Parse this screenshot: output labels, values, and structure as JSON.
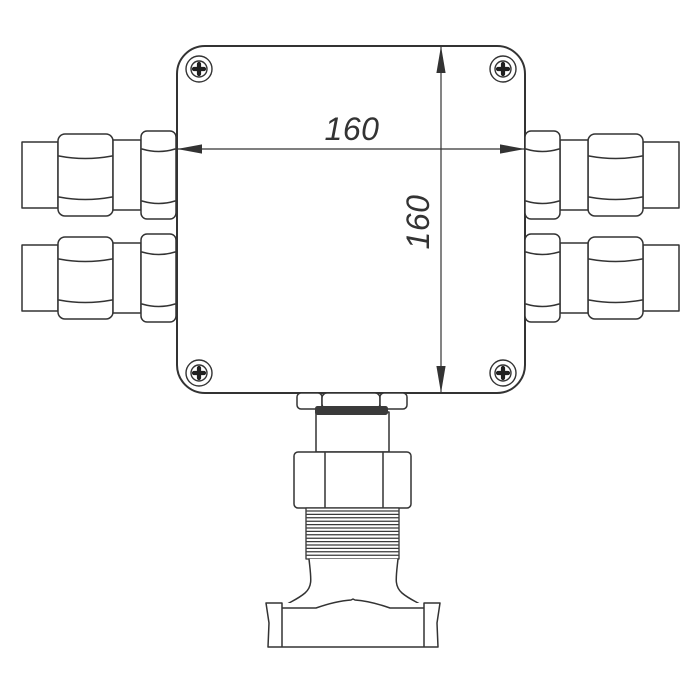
{
  "drawing": {
    "kind": "junction-box-front-view"
  },
  "dimensions": {
    "width_label": "160",
    "height_label": "160"
  },
  "colors": {
    "line": "#333333",
    "background": "#ffffff",
    "dark_fill": "#3a3a3a",
    "screw_cross": "#1f1f1f"
  }
}
